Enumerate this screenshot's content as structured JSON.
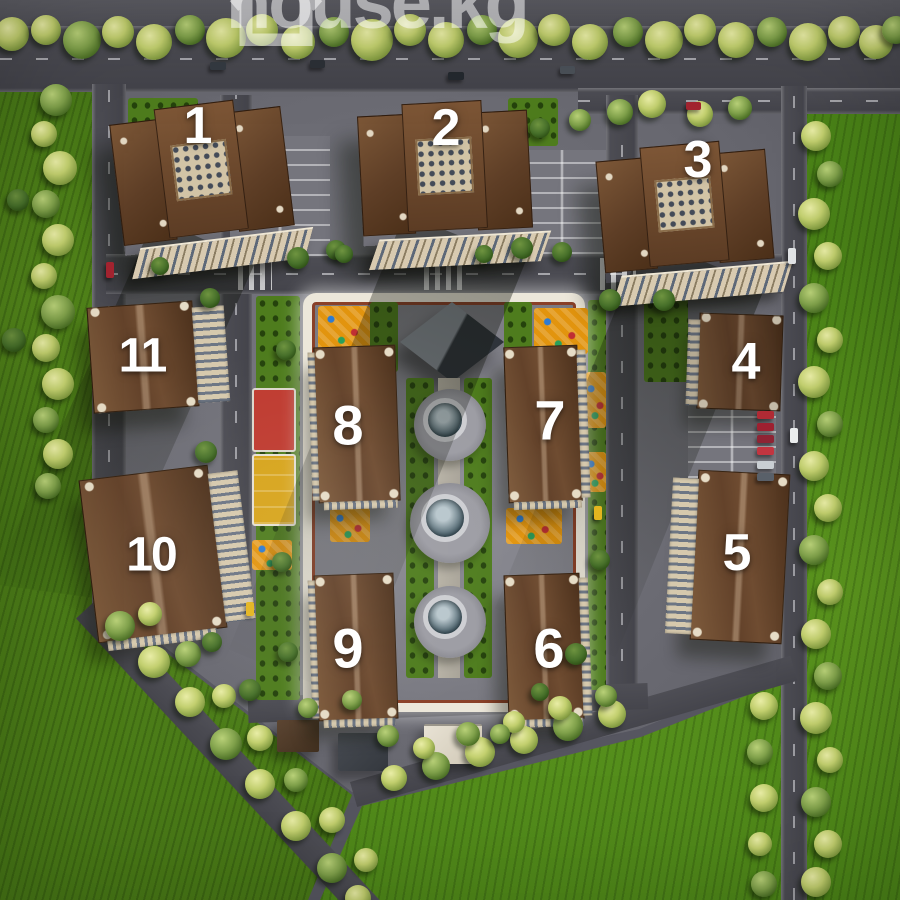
{
  "watermark": {
    "icon": "house-outline-icon",
    "text": "house.kg"
  },
  "site": {
    "buildings": [
      {
        "label": "1"
      },
      {
        "label": "2"
      },
      {
        "label": "3"
      },
      {
        "label": "4"
      },
      {
        "label": "5"
      },
      {
        "label": "6"
      },
      {
        "label": "7"
      },
      {
        "label": "8"
      },
      {
        "label": "9"
      },
      {
        "label": "10"
      },
      {
        "label": "11"
      }
    ],
    "features": [
      "glass-pyramid",
      "fountain-alley",
      "basketball-court",
      "playgrounds",
      "guest-parking",
      "jogging-track",
      "green-fields",
      "tree-lined-roads"
    ]
  },
  "palette": {
    "field_green": "#477716",
    "lawn_green": "#4e7c1d",
    "road_gray": "#4a4a51",
    "pavement_gray": "#6e6e76",
    "roof_brown": "#5f4027",
    "facade_cream": "#d8cab0",
    "path_white": "#ece7da",
    "track_red": "#8a4028",
    "playground_orange": "#e2940e",
    "court_red": "#bf3b30",
    "water_teal": "#3c545f",
    "number_white": "#ffffff",
    "watermark_white": "rgba(255,255,255,0.52)"
  }
}
